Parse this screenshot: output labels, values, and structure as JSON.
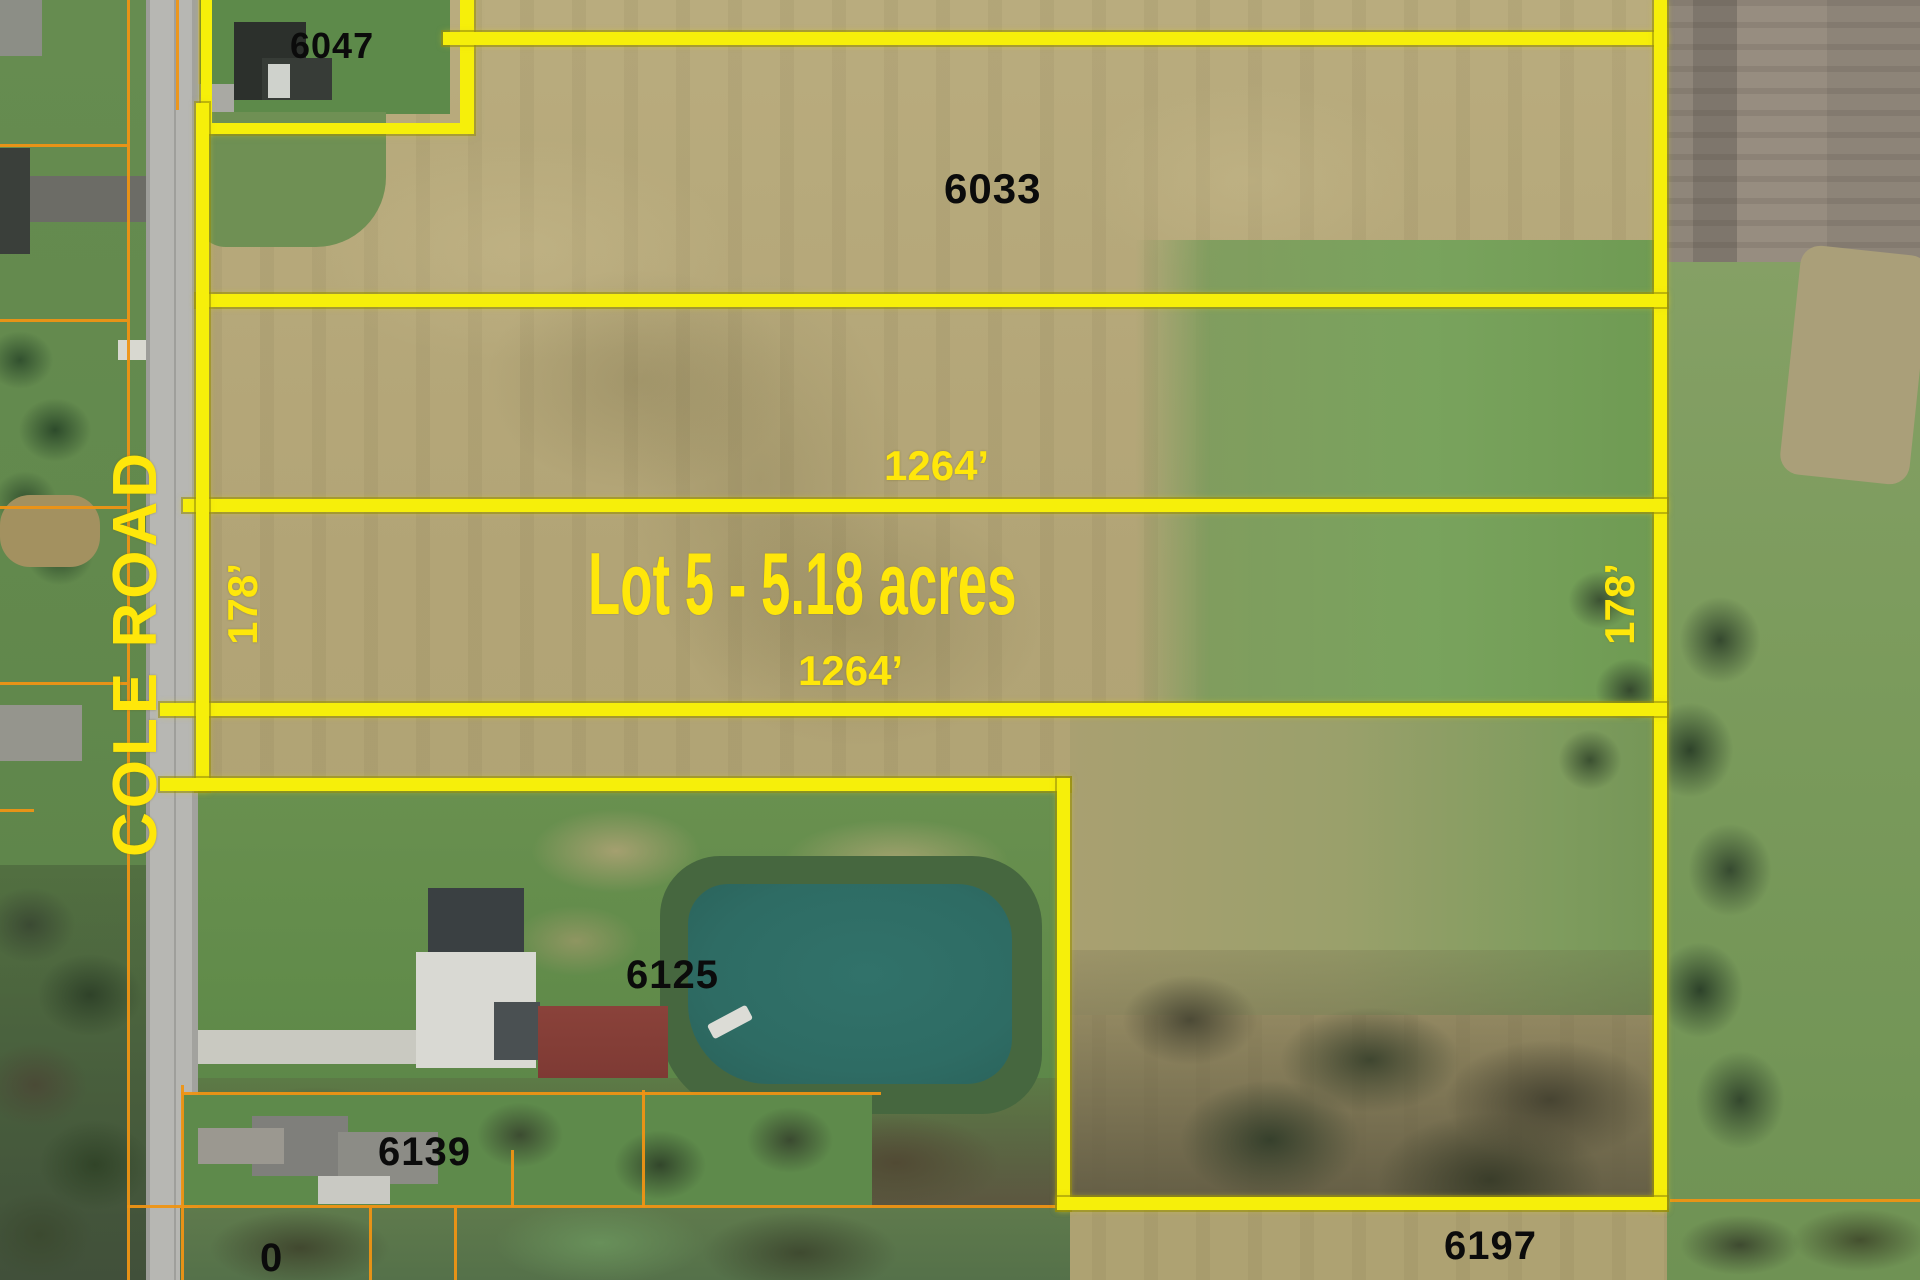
{
  "map": {
    "title": "Aerial parcel map - Lot 5 for sale along Cole Road",
    "road_label": "COLE ROAD",
    "lot_label": "Lot 5 - 5.18 acres",
    "dimensions": {
      "top_width": "1264’",
      "bottom_width": "1264’",
      "west_depth": "178’",
      "east_depth": "178’"
    },
    "parcels": {
      "p6047": "6047",
      "p6033": "6033",
      "p6125": "6125",
      "p6139": "6139",
      "p6197": "6197",
      "p0": "0"
    },
    "colors": {
      "boundary_yellow": "#f6ef0a",
      "label_yellow": "#ffe70a",
      "parcel_line_orange": "#ee9414",
      "parcel_number_black": "#0b0b0b",
      "pond_teal": "#2e6c64",
      "road_gray": "#b7b7b3"
    }
  }
}
